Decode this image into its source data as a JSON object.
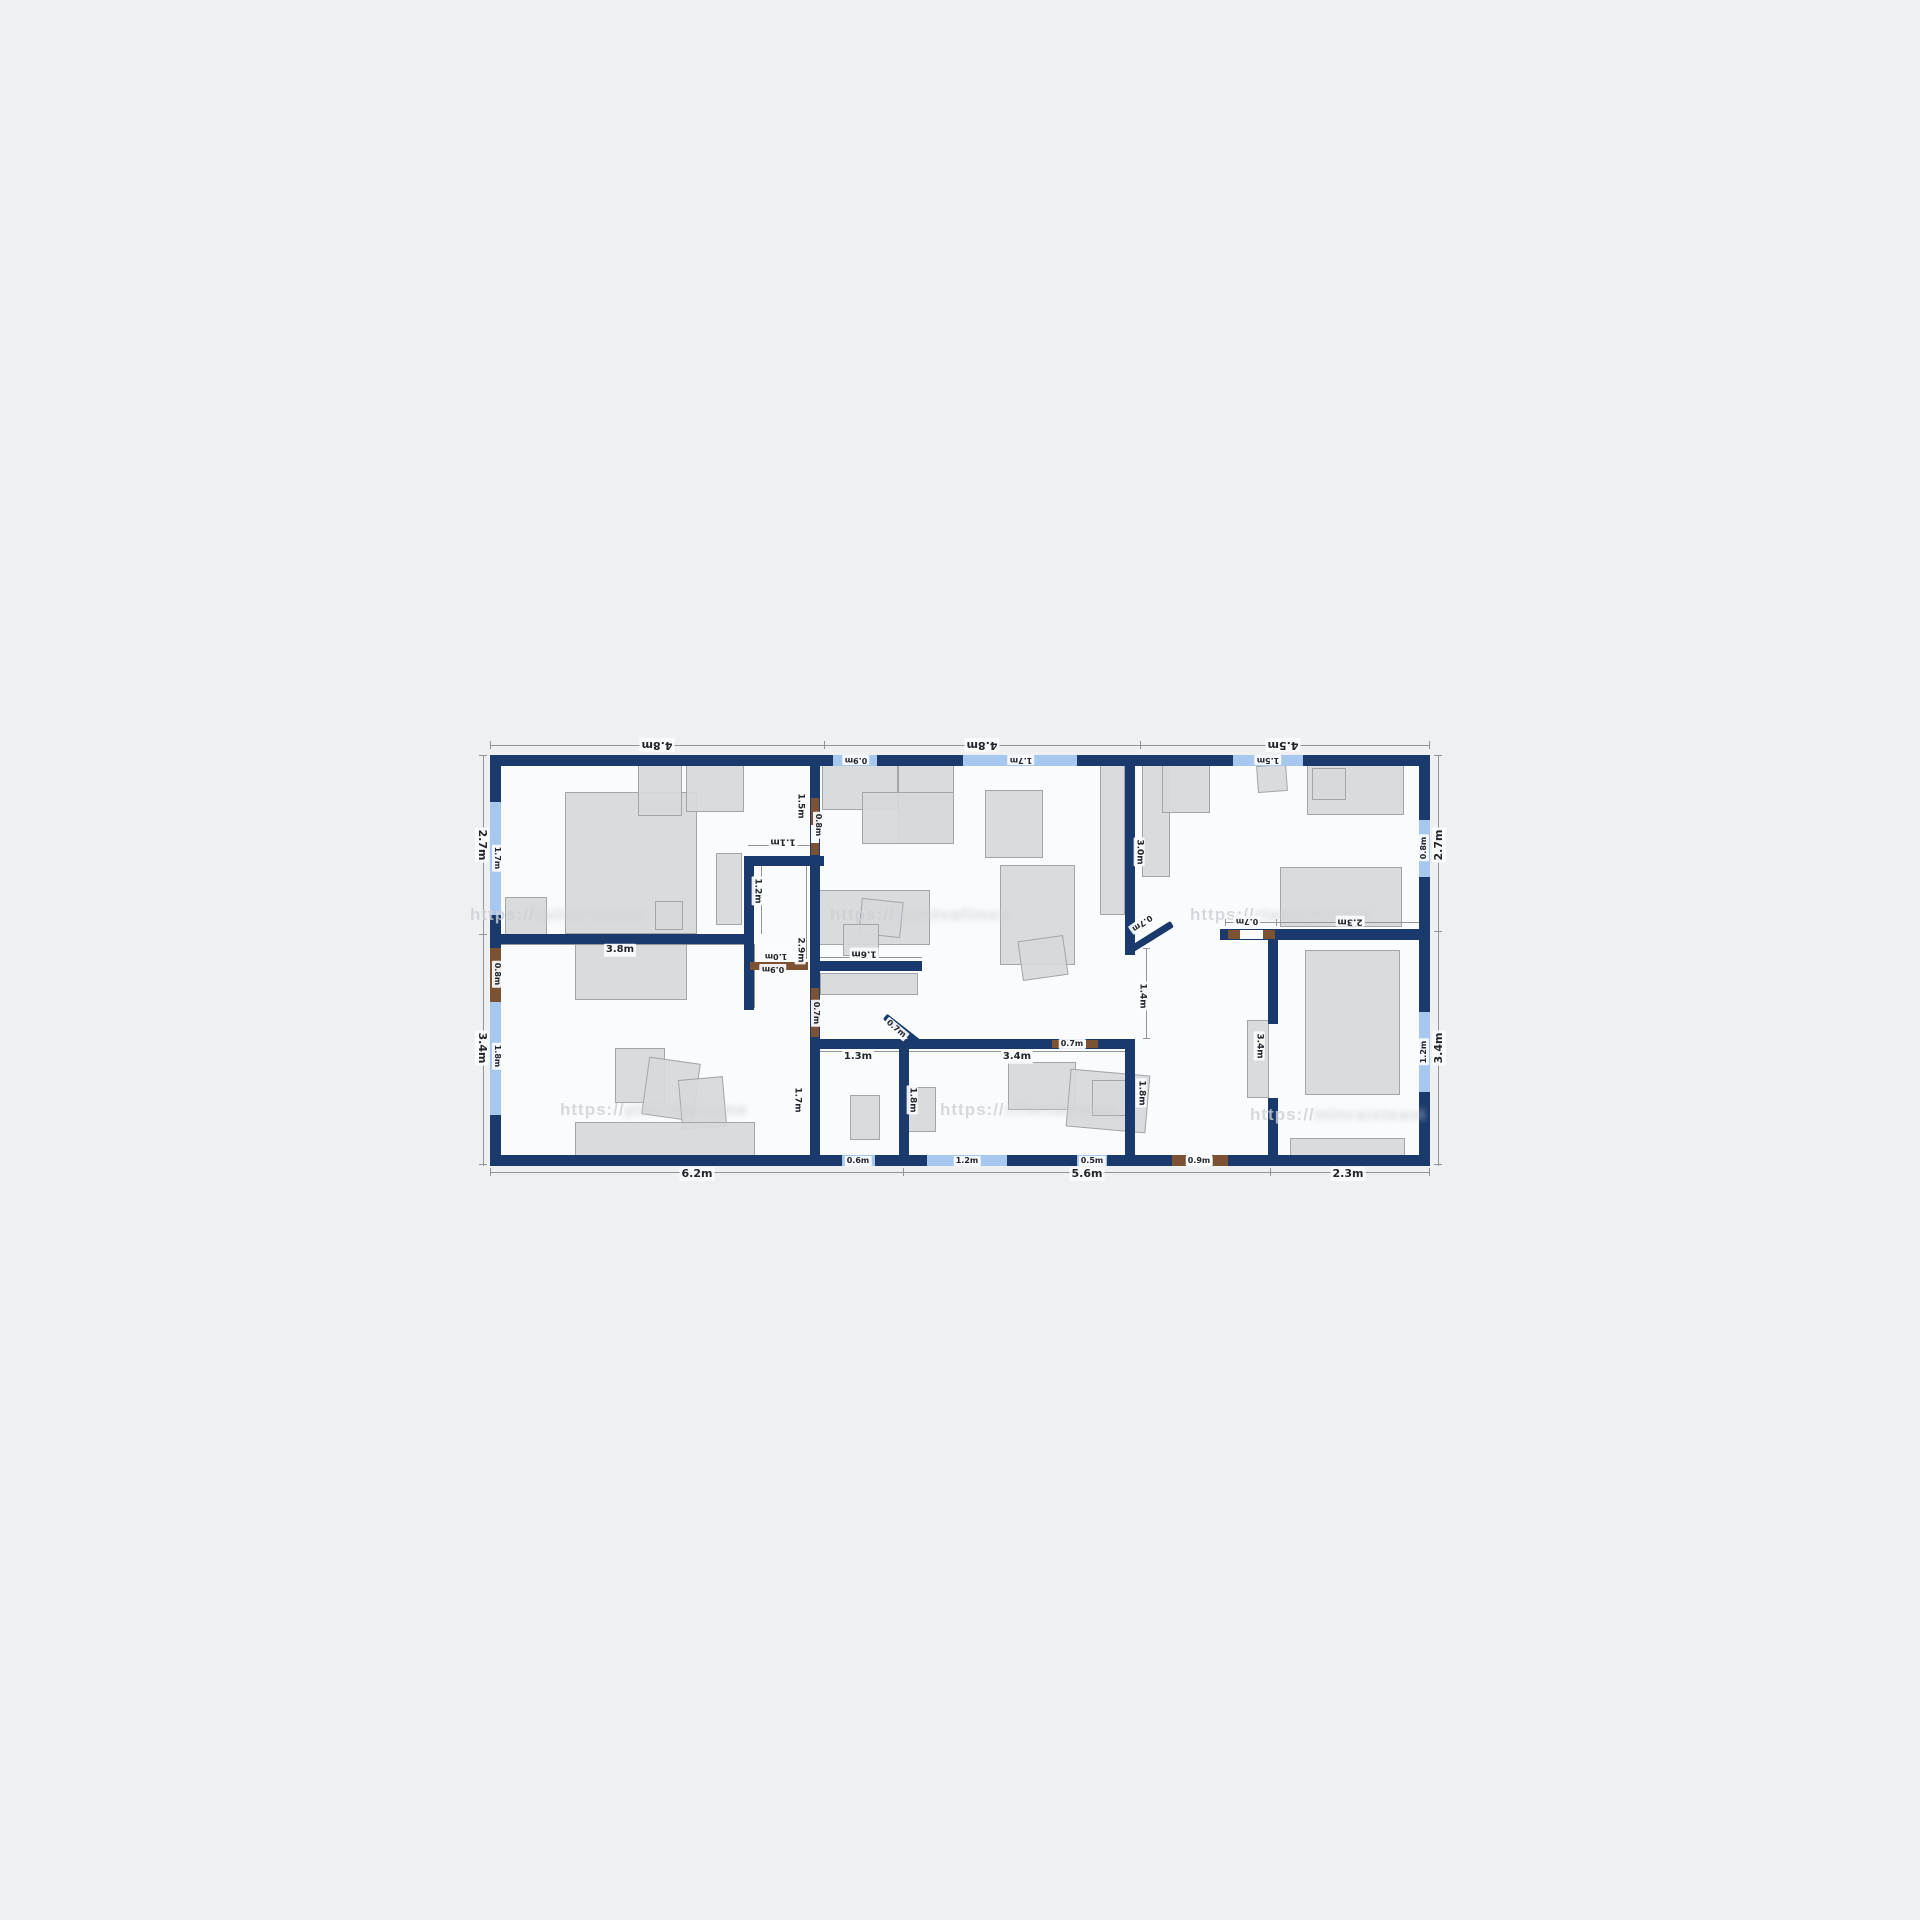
{
  "colors": {
    "background": "#eff0f2",
    "floor": "#fafbfc",
    "wall_navy": "#1a3a6d",
    "window_blue": "#a6c8ef",
    "door_brown": "#7d5233",
    "dimension_grey": "#8f959b",
    "label_text": "#22262c",
    "furniture_grey": "#d7d8da"
  },
  "plan": {
    "floor": {
      "x": 495,
      "y": 760,
      "w": 930,
      "h": 400
    },
    "walls": [
      {
        "x": 490,
        "y": 755,
        "w": 940,
        "h": 11
      },
      {
        "x": 490,
        "y": 1155,
        "w": 940,
        "h": 11
      },
      {
        "x": 490,
        "y": 755,
        "w": 11,
        "h": 411
      },
      {
        "x": 1419,
        "y": 755,
        "w": 11,
        "h": 411
      },
      {
        "x": 496,
        "y": 934,
        "w": 258,
        "h": 10
      },
      {
        "x": 744,
        "y": 856,
        "w": 10,
        "h": 154
      },
      {
        "x": 744,
        "y": 856,
        "w": 80,
        "h": 10
      },
      {
        "x": 810,
        "y": 765,
        "w": 10,
        "h": 390
      },
      {
        "x": 810,
        "y": 961,
        "w": 112,
        "h": 10
      },
      {
        "x": 810,
        "y": 1039,
        "w": 325,
        "h": 10
      },
      {
        "x": 899,
        "y": 1039,
        "w": 10,
        "h": 116
      },
      {
        "x": 1125,
        "y": 765,
        "w": 10,
        "h": 190
      },
      {
        "x": 1125,
        "y": 1039,
        "w": 10,
        "h": 116
      },
      {
        "x": 1268,
        "y": 929,
        "w": 10,
        "h": 95
      },
      {
        "x": 1268,
        "y": 1098,
        "w": 10,
        "h": 57
      },
      {
        "x": 1220,
        "y": 929,
        "w": 210,
        "h": 11
      }
    ],
    "windows": [
      {
        "x": 833,
        "y": 755,
        "w": 44,
        "h": 11
      },
      {
        "x": 963,
        "y": 755,
        "w": 114,
        "h": 11
      },
      {
        "x": 1233,
        "y": 755,
        "w": 70,
        "h": 11
      },
      {
        "x": 490,
        "y": 802,
        "w": 11,
        "h": 113
      },
      {
        "x": 490,
        "y": 1002,
        "w": 11,
        "h": 113
      },
      {
        "x": 1419,
        "y": 820,
        "w": 11,
        "h": 57
      },
      {
        "x": 1419,
        "y": 1012,
        "w": 11,
        "h": 80
      },
      {
        "x": 842,
        "y": 1155,
        "w": 33,
        "h": 11
      },
      {
        "x": 927,
        "y": 1155,
        "w": 80,
        "h": 11
      },
      {
        "x": 1077,
        "y": 1155,
        "w": 30,
        "h": 11
      }
    ],
    "doors": [
      {
        "x": 490,
        "y": 948,
        "w": 11,
        "h": 54
      },
      {
        "x": 811,
        "y": 798,
        "w": 8,
        "h": 27
      },
      {
        "x": 811,
        "y": 843,
        "w": 8,
        "h": 12
      },
      {
        "x": 811,
        "y": 988,
        "w": 8,
        "h": 49
      },
      {
        "x": 750,
        "y": 962,
        "w": 58,
        "h": 8
      },
      {
        "x": 1052,
        "y": 1040,
        "w": 12,
        "h": 8
      },
      {
        "x": 1086,
        "y": 1040,
        "w": 12,
        "h": 8
      },
      {
        "x": 1228,
        "y": 930,
        "w": 12,
        "h": 9
      },
      {
        "x": 1263,
        "y": 930,
        "w": 12,
        "h": 9
      },
      {
        "x": 1172,
        "y": 1155,
        "w": 14,
        "h": 11
      },
      {
        "x": 1212,
        "y": 1155,
        "w": 16,
        "h": 11
      }
    ],
    "door_gaps": [
      {
        "x": 811,
        "y": 825,
        "w": 8,
        "h": 18
      },
      {
        "x": 1064,
        "y": 1040,
        "w": 22,
        "h": 8
      },
      {
        "x": 1240,
        "y": 930,
        "w": 23,
        "h": 9
      },
      {
        "x": 1186,
        "y": 1155,
        "w": 26,
        "h": 11
      }
    ],
    "diagonals": [
      {
        "x": 885,
        "y": 1016,
        "w": 44,
        "r": 38
      },
      {
        "x": 1128,
        "y": 951,
        "w": 52,
        "r": -32
      }
    ],
    "dims": [
      {
        "x": 490,
        "y": 745,
        "w": 940,
        "h": 1
      },
      {
        "x": 490,
        "y": 1172,
        "w": 940,
        "h": 1
      },
      {
        "x": 483,
        "y": 755,
        "w": 1,
        "h": 411
      },
      {
        "x": 1438,
        "y": 755,
        "w": 1,
        "h": 411
      },
      {
        "x": 496,
        "y": 944,
        "w": 252,
        "h": 1
      },
      {
        "x": 748,
        "y": 845,
        "w": 62,
        "h": 1
      },
      {
        "x": 818,
        "y": 957,
        "w": 104,
        "h": 1
      },
      {
        "x": 815,
        "y": 1051,
        "w": 84,
        "h": 1
      },
      {
        "x": 909,
        "y": 1051,
        "w": 216,
        "h": 1
      },
      {
        "x": 1146,
        "y": 948,
        "w": 1,
        "h": 91
      },
      {
        "x": 1225,
        "y": 922,
        "w": 205,
        "h": 1
      },
      {
        "x": 761,
        "y": 866,
        "w": 1,
        "h": 68
      },
      {
        "x": 754,
        "y": 944,
        "w": 1,
        "h": 64
      },
      {
        "x": 806,
        "y": 866,
        "w": 1,
        "h": 93
      }
    ],
    "ticks": [
      {
        "x": 490,
        "y": 741,
        "w": 1,
        "h": 8
      },
      {
        "x": 824,
        "y": 741,
        "w": 1,
        "h": 8
      },
      {
        "x": 1140,
        "y": 741,
        "w": 1,
        "h": 8
      },
      {
        "x": 1429,
        "y": 741,
        "w": 1,
        "h": 8
      },
      {
        "x": 490,
        "y": 1168,
        "w": 1,
        "h": 8
      },
      {
        "x": 903,
        "y": 1168,
        "w": 1,
        "h": 8
      },
      {
        "x": 1270,
        "y": 1168,
        "w": 1,
        "h": 8
      },
      {
        "x": 1429,
        "y": 1168,
        "w": 1,
        "h": 8
      },
      {
        "x": 479,
        "y": 755,
        "w": 8,
        "h": 1
      },
      {
        "x": 479,
        "y": 934,
        "w": 8,
        "h": 1
      },
      {
        "x": 479,
        "y": 1164,
        "w": 8,
        "h": 1
      },
      {
        "x": 1434,
        "y": 755,
        "w": 8,
        "h": 1
      },
      {
        "x": 1434,
        "y": 931,
        "w": 8,
        "h": 1
      },
      {
        "x": 1434,
        "y": 1164,
        "w": 8,
        "h": 1
      },
      {
        "x": 496,
        "y": 941,
        "w": 1,
        "h": 7
      },
      {
        "x": 747,
        "y": 941,
        "w": 1,
        "h": 7
      },
      {
        "x": 1225,
        "y": 919,
        "w": 1,
        "h": 7
      },
      {
        "x": 1276,
        "y": 919,
        "w": 1,
        "h": 7
      },
      {
        "x": 1429,
        "y": 919,
        "w": 1,
        "h": 7
      },
      {
        "x": 1143,
        "y": 948,
        "w": 7,
        "h": 1
      },
      {
        "x": 1143,
        "y": 1038,
        "w": 7,
        "h": 1
      }
    ],
    "labels": [
      {
        "t": "4.8m",
        "x": 657,
        "y": 745,
        "r": 180,
        "s": 11
      },
      {
        "t": "4.8m",
        "x": 982,
        "y": 745,
        "r": 180,
        "s": 11
      },
      {
        "t": "4.5m",
        "x": 1283,
        "y": 745,
        "r": 180,
        "s": 11
      },
      {
        "t": "2.7m",
        "x": 482,
        "y": 845,
        "r": 90,
        "s": 11
      },
      {
        "t": "3.4m",
        "x": 482,
        "y": 1048,
        "r": 90,
        "s": 11
      },
      {
        "t": "2.7m",
        "x": 1439,
        "y": 845,
        "r": -90,
        "s": 11
      },
      {
        "t": "3.4m",
        "x": 1439,
        "y": 1048,
        "r": -90,
        "s": 11
      },
      {
        "t": "6.2m",
        "x": 697,
        "y": 1174,
        "r": 0,
        "s": 11
      },
      {
        "t": "5.6m",
        "x": 1087,
        "y": 1174,
        "r": 0,
        "s": 11
      },
      {
        "t": "2.3m",
        "x": 1348,
        "y": 1174,
        "r": 0,
        "s": 11
      },
      {
        "t": "0.9m",
        "x": 856,
        "y": 760,
        "r": 180,
        "s": 8
      },
      {
        "t": "1.7m",
        "x": 1021,
        "y": 760,
        "r": 180,
        "s": 8
      },
      {
        "t": "1.5m",
        "x": 1268,
        "y": 760,
        "r": 180,
        "s": 8
      },
      {
        "t": "1.7m",
        "x": 497,
        "y": 858,
        "r": 90,
        "s": 8
      },
      {
        "t": "0.8m",
        "x": 497,
        "y": 974,
        "r": 90,
        "s": 8
      },
      {
        "t": "1.8m",
        "x": 497,
        "y": 1056,
        "r": 90,
        "s": 8
      },
      {
        "t": "0.8m",
        "x": 1424,
        "y": 848,
        "r": -90,
        "s": 8
      },
      {
        "t": "1.2m",
        "x": 1424,
        "y": 1052,
        "r": -90,
        "s": 8
      },
      {
        "t": "0.6m",
        "x": 858,
        "y": 1161,
        "r": 0,
        "s": 8
      },
      {
        "t": "1.2m",
        "x": 967,
        "y": 1161,
        "r": 0,
        "s": 8
      },
      {
        "t": "0.5m",
        "x": 1092,
        "y": 1161,
        "r": 0,
        "s": 8
      },
      {
        "t": "0.9m",
        "x": 1199,
        "y": 1161,
        "r": 0,
        "s": 8
      },
      {
        "t": "0.8m",
        "x": 818,
        "y": 825,
        "r": 90,
        "s": 8
      },
      {
        "t": "0.7m",
        "x": 816,
        "y": 1013,
        "r": 90,
        "s": 8
      },
      {
        "t": "3.8m",
        "x": 620,
        "y": 950,
        "r": 0,
        "s": 10
      },
      {
        "t": "1.1m",
        "x": 783,
        "y": 841,
        "r": 180,
        "s": 9
      },
      {
        "t": "1.2m",
        "x": 757,
        "y": 891,
        "r": 90,
        "s": 9
      },
      {
        "t": "1.5m",
        "x": 800,
        "y": 806,
        "r": 90,
        "s": 9
      },
      {
        "t": "2.9m",
        "x": 800,
        "y": 950,
        "r": 90,
        "s": 9
      },
      {
        "t": "1.0m",
        "x": 776,
        "y": 956,
        "r": 180,
        "s": 8
      },
      {
        "t": "0.9m",
        "x": 773,
        "y": 969,
        "r": 180,
        "s": 8
      },
      {
        "t": "1.6m",
        "x": 864,
        "y": 953,
        "r": 180,
        "s": 9
      },
      {
        "t": "1.3m",
        "x": 858,
        "y": 1057,
        "r": 0,
        "s": 10
      },
      {
        "t": "3.4m",
        "x": 1017,
        "y": 1057,
        "r": 0,
        "s": 10
      },
      {
        "t": "0.7m",
        "x": 1072,
        "y": 1044,
        "r": 0,
        "s": 8
      },
      {
        "t": "1.7m",
        "x": 797,
        "y": 1100,
        "r": 90,
        "s": 9
      },
      {
        "t": "1.8m",
        "x": 912,
        "y": 1100,
        "r": 90,
        "s": 9
      },
      {
        "t": "1.8m",
        "x": 1141,
        "y": 1093,
        "r": 90,
        "s": 9
      },
      {
        "t": "1.4m",
        "x": 1142,
        "y": 996,
        "r": 90,
        "s": 9
      },
      {
        "t": "3.0m",
        "x": 1139,
        "y": 852,
        "r": 90,
        "s": 9
      },
      {
        "t": "3.4m",
        "x": 1259,
        "y": 1046,
        "r": 90,
        "s": 9
      },
      {
        "t": "0.7m",
        "x": 1247,
        "y": 921,
        "r": 180,
        "s": 8
      },
      {
        "t": "2.3m",
        "x": 1350,
        "y": 921,
        "r": 180,
        "s": 9
      },
      {
        "t": "0.7m",
        "x": 1142,
        "y": 923,
        "r": 145,
        "s": 8
      },
      {
        "t": "0.7m",
        "x": 896,
        "y": 1029,
        "r": 40,
        "s": 8
      }
    ],
    "furniture": [
      {
        "x": 565,
        "y": 792,
        "w": 132,
        "h": 142,
        "r": 0
      },
      {
        "x": 638,
        "y": 764,
        "w": 44,
        "h": 52,
        "r": 0
      },
      {
        "x": 686,
        "y": 764,
        "w": 58,
        "h": 48,
        "r": 0
      },
      {
        "x": 505,
        "y": 897,
        "w": 42,
        "h": 40,
        "r": 0
      },
      {
        "x": 716,
        "y": 853,
        "w": 26,
        "h": 72,
        "r": 0
      },
      {
        "x": 655,
        "y": 901,
        "w": 28,
        "h": 29,
        "r": 0
      },
      {
        "x": 575,
        "y": 935,
        "w": 112,
        "h": 65,
        "r": 0
      },
      {
        "x": 615,
        "y": 1048,
        "w": 50,
        "h": 55,
        "r": 0
      },
      {
        "x": 645,
        "y": 1060,
        "w": 52,
        "h": 58,
        "r": 8
      },
      {
        "x": 680,
        "y": 1078,
        "w": 45,
        "h": 50,
        "r": -5
      },
      {
        "x": 575,
        "y": 1122,
        "w": 180,
        "h": 36,
        "r": 0
      },
      {
        "x": 822,
        "y": 764,
        "w": 76,
        "h": 46,
        "r": 0
      },
      {
        "x": 898,
        "y": 764,
        "w": 56,
        "h": 80,
        "r": 0
      },
      {
        "x": 862,
        "y": 792,
        "w": 92,
        "h": 52,
        "r": 0
      },
      {
        "x": 985,
        "y": 790,
        "w": 58,
        "h": 68,
        "r": 0
      },
      {
        "x": 1100,
        "y": 765,
        "w": 25,
        "h": 150,
        "r": 0
      },
      {
        "x": 818,
        "y": 890,
        "w": 112,
        "h": 55,
        "r": 0
      },
      {
        "x": 860,
        "y": 900,
        "w": 42,
        "h": 36,
        "r": 6
      },
      {
        "x": 843,
        "y": 924,
        "w": 36,
        "h": 32,
        "r": 0
      },
      {
        "x": 1000,
        "y": 865,
        "w": 75,
        "h": 100,
        "r": 0
      },
      {
        "x": 1020,
        "y": 938,
        "w": 46,
        "h": 40,
        "r": -8
      },
      {
        "x": 820,
        "y": 973,
        "w": 98,
        "h": 22,
        "r": 0
      },
      {
        "x": 850,
        "y": 1095,
        "w": 30,
        "h": 45,
        "r": 0
      },
      {
        "x": 908,
        "y": 1087,
        "w": 28,
        "h": 45,
        "r": 0
      },
      {
        "x": 1008,
        "y": 1062,
        "w": 68,
        "h": 48,
        "r": 0
      },
      {
        "x": 1068,
        "y": 1072,
        "w": 80,
        "h": 58,
        "r": 5
      },
      {
        "x": 1092,
        "y": 1080,
        "w": 42,
        "h": 36,
        "r": 0
      },
      {
        "x": 1305,
        "y": 950,
        "w": 95,
        "h": 145,
        "r": 0
      },
      {
        "x": 1290,
        "y": 1138,
        "w": 115,
        "h": 24,
        "r": 0
      },
      {
        "x": 1247,
        "y": 1020,
        "w": 22,
        "h": 78,
        "r": 0
      },
      {
        "x": 1142,
        "y": 765,
        "w": 28,
        "h": 112,
        "r": 0
      },
      {
        "x": 1257,
        "y": 765,
        "w": 30,
        "h": 27,
        "r": -4
      },
      {
        "x": 1307,
        "y": 763,
        "w": 97,
        "h": 52,
        "r": 0
      },
      {
        "x": 1312,
        "y": 768,
        "w": 34,
        "h": 32,
        "r": 0
      },
      {
        "x": 1280,
        "y": 867,
        "w": 122,
        "h": 60,
        "r": 0
      },
      {
        "x": 1162,
        "y": 763,
        "w": 48,
        "h": 50,
        "r": 0
      }
    ],
    "watermarks": [
      {
        "x": 470,
        "y": 905,
        "t": "https://",
        "blur": "tailmrneslim"
      },
      {
        "x": 830,
        "y": 905,
        "t": "https://",
        "blur": "lbimtvafimes"
      },
      {
        "x": 1190,
        "y": 905,
        "t": "https://",
        "blur": "rtameinlsgae"
      },
      {
        "x": 560,
        "y": 1100,
        "t": "https://",
        "blur": "plmrtanisume"
      },
      {
        "x": 940,
        "y": 1100,
        "t": "https://",
        "blur": "stiwnalrmiec"
      },
      {
        "x": 1250,
        "y": 1105,
        "t": "https://",
        "blur": "mlnraisteavi"
      }
    ]
  }
}
